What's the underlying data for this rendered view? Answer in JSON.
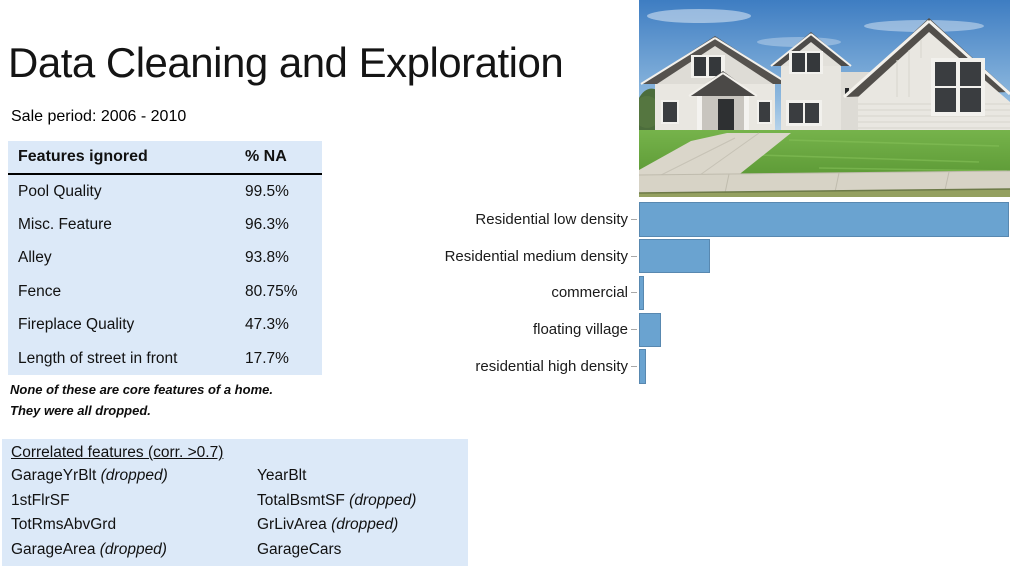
{
  "slide": {
    "title": "Data Cleaning and Exploration",
    "subtitle": "Sale period: 2006 - 2010"
  },
  "na_table": {
    "headers": [
      "Features ignored",
      "% NA"
    ],
    "rows": [
      [
        "Pool Quality",
        "99.5%"
      ],
      [
        "Misc. Feature",
        "96.3%"
      ],
      [
        "Alley",
        "93.8%"
      ],
      [
        "Fence",
        "80.75%"
      ],
      [
        "Fireplace Quality",
        "47.3%"
      ],
      [
        "Length of street in front",
        "17.7%"
      ]
    ],
    "note_line1": "None of these are core features of a home.",
    "note_line2": "They were all dropped.",
    "bg_color": "#dce9f8"
  },
  "correlated": {
    "heading": "Correlated features (corr. >0.7)",
    "pairs": [
      {
        "left": "GarageYrBlt",
        "left_note": "(dropped)",
        "right": "YearBlt",
        "right_note": ""
      },
      {
        "left": "1stFlrSF",
        "left_note": "",
        "right": "TotalBsmtSF",
        "right_note": "(dropped)"
      },
      {
        "left": "TotRmsAbvGrd",
        "left_note": "",
        "right": "GrLivArea",
        "right_note": "(dropped)"
      },
      {
        "left": "GarageArea",
        "left_note": "(dropped)",
        "right": "GarageCars",
        "right_note": ""
      }
    ],
    "bg_color": "#dce9f8"
  },
  "chart_data": {
    "type": "bar",
    "orientation": "horizontal",
    "title": "",
    "xlabel": "",
    "ylabel": "",
    "categories": [
      "Residential low density",
      "Residential medium density",
      "commercial",
      "floating village",
      "residential high density"
    ],
    "values": [
      100,
      19.2,
      1.4,
      6.0,
      1.9
    ],
    "values_unit": "relative bar length, % of longest bar (value axis not labeled in image)",
    "xlim": [
      0,
      100
    ],
    "grid": false,
    "legend": false,
    "bar_color": "#6aa3d0",
    "bar_border_color": "#5888b0"
  },
  "photo": {
    "description": "Photo of a modern farmhouse: white board-and-batten siding, dark gray gabled roofs, covered porch, large windows, green lawn, concrete driveway and sidewalk under a blue sky"
  }
}
